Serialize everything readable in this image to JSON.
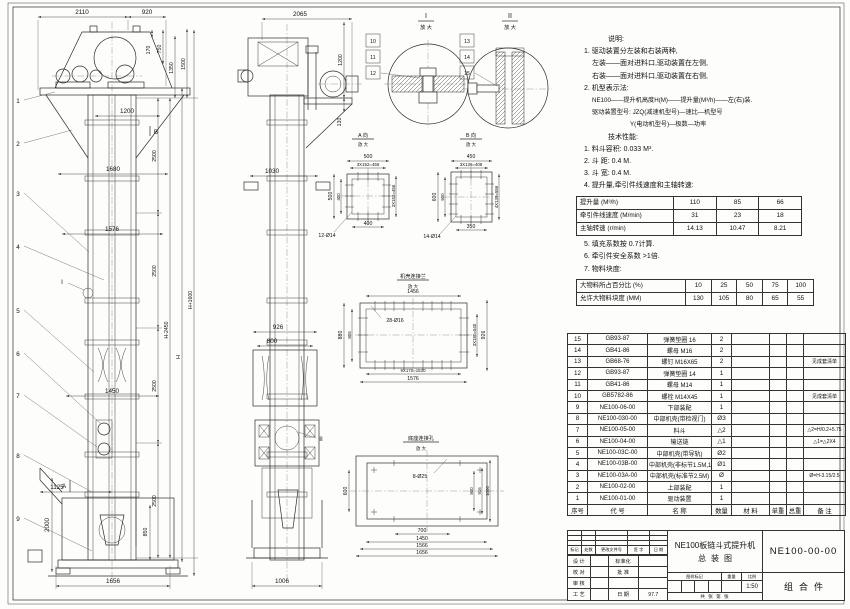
{
  "notes": {
    "heading": "说明:",
    "items": [
      "1. 驱动装置分左装和右装两种,",
      "左装——面对进料口,驱动装置在左侧,",
      "右装——面对进料口,驱动装置在右侧,",
      "2. 机型表示法:",
      "NE100——提升机高度H(M)——提升量(M³/h)——左(右)装.",
      "驱动装置型号: JZQ(减速机型号)—速比—机型号",
      "Y(电动机型号)—极数—功率"
    ]
  },
  "tech": {
    "heading": "技术性能:",
    "items_before": [
      "1. 料斗容积: 0.033 M³.",
      "2. 斗  距: 0.4 M.",
      "3. 斗  宽: 0.4 M.",
      "4. 提升量,牵引件线速度和主轴转速:"
    ],
    "items_after": [
      "5. 填充系数按 0.7计算.",
      "6. 牵引件安全系数 >1倍.",
      "7. 物料块度:"
    ]
  },
  "perf_table": {
    "rows": [
      [
        "提升量 (M³/h)",
        "110",
        "85",
        "66"
      ],
      [
        "牵引件线速度 (M/min)",
        "31",
        "23",
        "18"
      ],
      [
        "主轴转速 (r/min)",
        "14.13",
        "10.47",
        "8.21"
      ]
    ]
  },
  "lump_table": {
    "rows": [
      [
        "大物料所占百分比 (%)",
        "10",
        "25",
        "50",
        "75",
        "100"
      ],
      [
        "允许大物料块度 (MM)",
        "130",
        "105",
        "80",
        "65",
        "55"
      ]
    ]
  },
  "bom": {
    "headers": [
      "序号",
      "代  号",
      "名    称",
      "数量",
      "材  料",
      "单重",
      "总重",
      "备  注"
    ],
    "rows": [
      [
        "15",
        "GB93-87",
        "弹簧垫圈 16",
        "2",
        "",
        "",
        "",
        ""
      ],
      [
        "14",
        "GB41-86",
        "螺母 M16",
        "2",
        "",
        "",
        "",
        ""
      ],
      [
        "13",
        "GB68-76",
        "螺钉 M16X65",
        "2",
        "",
        "",
        "",
        "见成套清单"
      ],
      [
        "12",
        "GB93-87",
        "弹簧垫圈 14",
        "1",
        "",
        "",
        "",
        ""
      ],
      [
        "11",
        "GB41-86",
        "螺母 M14",
        "1",
        "",
        "",
        "",
        ""
      ],
      [
        "10",
        "GB5782-86",
        "螺栓 M14X45",
        "1",
        "",
        "",
        "",
        "见成套清单"
      ],
      [
        "9",
        "NE100-06-00",
        "下部装配",
        "1",
        "",
        "",
        "",
        ""
      ],
      [
        "8",
        "NE100-030-00",
        "中部机壳(带检视门)",
        "Ø3",
        "",
        "",
        "",
        ""
      ],
      [
        "7",
        "NE100-05-00",
        "料斗",
        "△2",
        "",
        "",
        "",
        "△2=H/0.2+5.75"
      ],
      [
        "6",
        "NE100-04-00",
        "输送链",
        "△1",
        "",
        "",
        "",
        "△1=△2X4"
      ],
      [
        "5",
        "NE100-03C-00",
        "中部机壳(带导轨)",
        "Ø2",
        "",
        "",
        "",
        ""
      ],
      [
        "4",
        "NE100-03B-00",
        "中部机壳(非标节1.5M,1M)",
        "Ø1",
        "",
        "",
        "",
        ""
      ],
      [
        "3",
        "NE100-03A-00",
        "中部机壳(标准节2.5M)",
        "Ø",
        "",
        "",
        "",
        "Ø=H-3.15/2.5"
      ],
      [
        "2",
        "NE100-02-00",
        "上部装配",
        "1",
        "",
        "",
        "",
        ""
      ],
      [
        "1",
        "NE100-01-00",
        "驱动装置",
        "1",
        "",
        "",
        "",
        ""
      ]
    ]
  },
  "title_block": {
    "product": "NE100板链斗式提升机",
    "drawing_name": "总装图",
    "drawing_no": "NE100-00-00",
    "part_type": "组合件",
    "rev_headers": [
      "标记",
      "处数",
      "更改文件号",
      "签 字",
      "日 期"
    ],
    "sig_rows": [
      [
        "设 计",
        "",
        "标准化",
        ""
      ],
      [
        "校 对",
        "",
        "批 准",
        ""
      ],
      [
        "审 核",
        "",
        "",
        ""
      ],
      [
        "工 艺",
        "",
        "日 期",
        "97.7"
      ]
    ],
    "stamp_headers": [
      "图样标记",
      "重量",
      "比例"
    ],
    "scale": "1:50",
    "sheet_note": "共  张    第  张"
  },
  "views": {
    "front": {
      "balloons": [
        "1",
        "2",
        "3",
        "4",
        "5",
        "6",
        "7",
        "8",
        "9"
      ],
      "section_a": "A",
      "section_b": "B",
      "detail_ref": "I",
      "d2110": "2110",
      "d920": "920",
      "d170": "170",
      "d750": "750",
      "d1350": "1350",
      "d1500": "1500",
      "d1200": "1200",
      "d1680": "1680",
      "d1576": "1576",
      "d1450": "1450",
      "d1125": "1125",
      "d2500": "2500",
      "dH2450": "H-2450",
      "dH": "H",
      "dH1600": "H+1600",
      "d2000": "2000",
      "d850": "850",
      "d1656": "1656"
    },
    "side": {
      "detail_ref": "II",
      "d2065": "2065",
      "d1200": "1200",
      "d130": "130",
      "d1030": "1030",
      "d926": "926",
      "d800": "800",
      "d1006": "1006"
    },
    "detail_i": {
      "title": "I",
      "sub": "放 大",
      "balloons": [
        "10",
        "11",
        "12"
      ]
    },
    "detail_ii": {
      "title": "II",
      "sub": "放 大",
      "balloons": [
        "13",
        "14",
        "15"
      ]
    },
    "view_a": {
      "title": "A 向",
      "sub": "放 大",
      "d500t": "500",
      "d456t": "3X152=456",
      "d500l": "500",
      "d400l": "400",
      "d456r": "3X152=456",
      "d400b": "400",
      "holes": "12-Ø14"
    },
    "view_b": {
      "title": "B 向",
      "sub": "放 大",
      "d450": "450",
      "d408": "3X136=408",
      "d600": "600",
      "d500": "500",
      "d556": "4X139=556",
      "d350": "350",
      "holes": "14-Ø14"
    },
    "flange_detail": {
      "title": "机壳连接兰",
      "sub": "放 大",
      "d1456": "1456",
      "holes": "28-Ø16",
      "d880": "880",
      "d806": "806",
      "d540": "3X180=540",
      "d926": "926",
      "d1530": "9X170=1530",
      "d1576": "1576"
    },
    "base_detail": {
      "title": "底座连接孔",
      "sub": "放 大",
      "holes": "8-Ø25",
      "d600": "600",
      "d800": "800",
      "d916": "916",
      "d1006": "1006",
      "d700": "700",
      "d1450": "1450",
      "d1566": "1566",
      "d1656": "1656"
    }
  }
}
